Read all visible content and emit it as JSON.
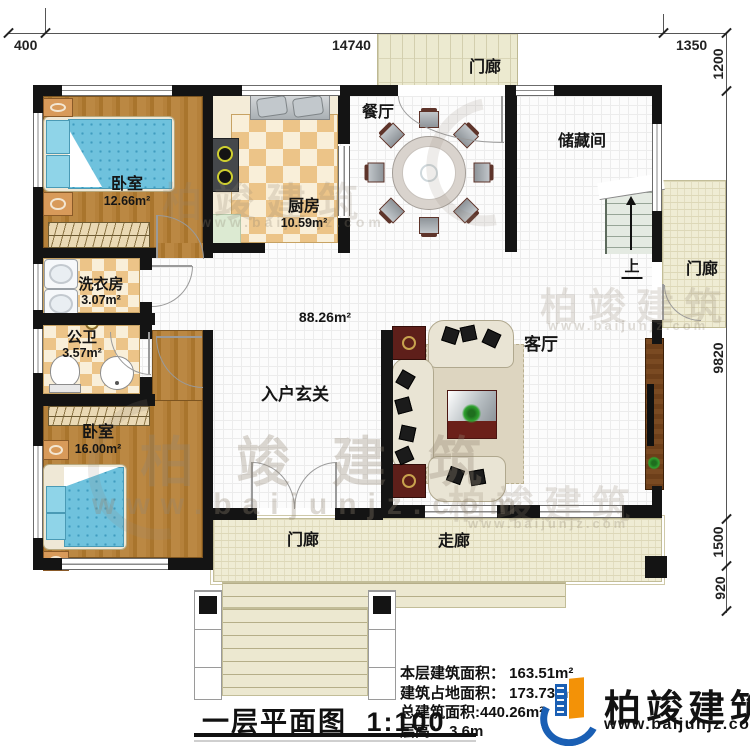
{
  "colors": {
    "wall": "#141414",
    "brand_blue": "#1a5fb4",
    "brand_orange": "#f39207",
    "wood": "#b5813b",
    "checker_tan": "#ecc488",
    "porch_beige": "#ecead0",
    "bed_blue": "#6fc2dd"
  },
  "dims": {
    "top": [
      {
        "label": "400"
      },
      {
        "label": "14740"
      },
      {
        "label": "1350"
      }
    ],
    "right": [
      {
        "label": "1200"
      },
      {
        "label": "9820"
      },
      {
        "label": "1500"
      },
      {
        "label": "920"
      }
    ]
  },
  "rooms": {
    "bedroom1": {
      "name": "卧室",
      "area": "12.66m²"
    },
    "kitchen": {
      "name": "厨房",
      "area": "10.59m²"
    },
    "dining": {
      "name": "餐厅"
    },
    "porch_top": {
      "name": "门廊"
    },
    "storage": {
      "name": "储藏间"
    },
    "stairs": {
      "up": "上"
    },
    "porch_right": {
      "name": "门廊"
    },
    "living": {
      "name": "客厅"
    },
    "foyer": {
      "name": "入户玄关",
      "area": "88.26m²"
    },
    "laundry": {
      "name": "洗衣房",
      "area": "3.07m²"
    },
    "bathroom": {
      "name": "公卫",
      "area": "3.57m²"
    },
    "bedroom2": {
      "name": "卧室",
      "area": "16.00m²"
    },
    "porch_bottom": {
      "name": "门廊"
    },
    "walkway": {
      "name": "走廊"
    }
  },
  "info": {
    "lines": [
      "本层建筑面积： 163.51m²",
      "建筑占地面积： 173.73m²",
      "总建筑面积:440.26m²",
      "层高： 3.6m"
    ]
  },
  "title": {
    "text": "一层平面图",
    "scale": "1:100"
  },
  "brand": {
    "name": "柏竣建筑",
    "url": "www.baijunjz.com"
  },
  "watermark": {
    "name": "柏竣建筑",
    "url": "www.baijunjz.com"
  }
}
